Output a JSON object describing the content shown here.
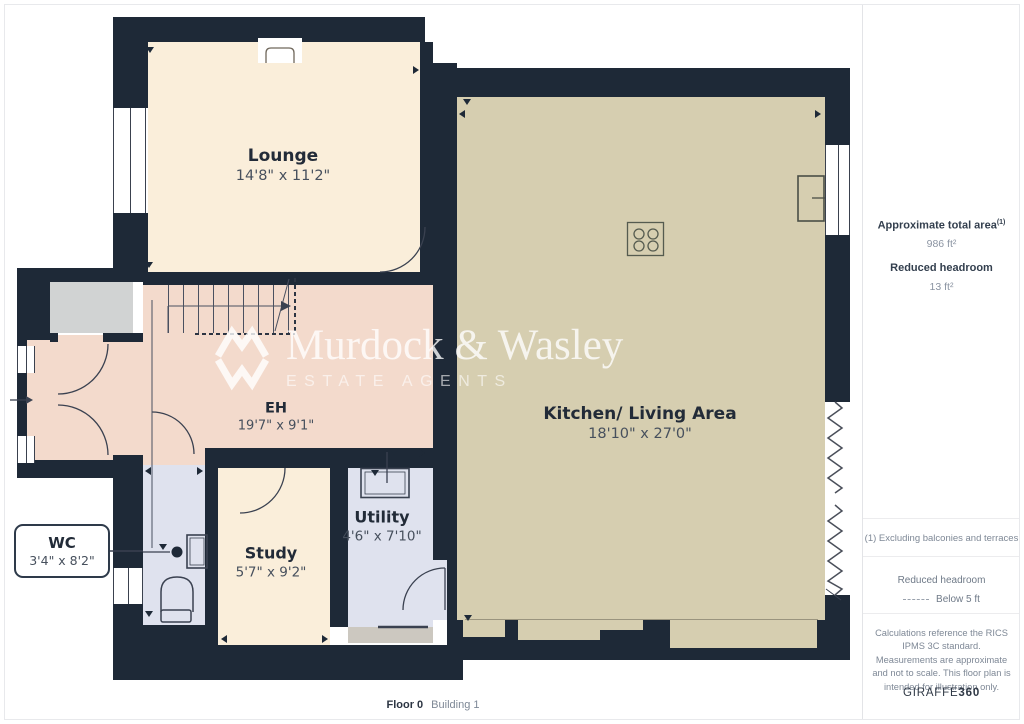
{
  "watermark": {
    "name": "Murdock & Wasley",
    "tagline": "ESTATE AGENTS",
    "logo": "mw-chevron-logo"
  },
  "rooms": [
    {
      "name": "Lounge",
      "dims": "14'8\" x 11'2\""
    },
    {
      "name": "Kitchen/ Living Area",
      "dims": "18'10\" x 27'0\""
    },
    {
      "name": "EH",
      "dims": "19'7\" x 9'1\""
    },
    {
      "name": "Study",
      "dims": "5'7\" x 9'2\""
    },
    {
      "name": "Utility",
      "dims": "4'6\" x 7'10\""
    },
    {
      "name": "WC",
      "dims": "3'4\" x 8'2\""
    }
  ],
  "footer": {
    "floor": "Floor 0",
    "building": "Building 1"
  },
  "sidebar": {
    "total_area_label": "Approximate total area",
    "total_area_sup": "(1)",
    "total_area_value": "986 ft²",
    "reduced_headroom_label": "Reduced headroom",
    "reduced_headroom_value": "13 ft²",
    "note1": "(1) Excluding balconies and terraces",
    "legend_title": "Reduced headroom",
    "legend_value": "Below 5 ft",
    "disclaimer": "Calculations reference the RICS IPMS 3C standard. Measurements are approximate and not to scale. This floor plan is intended for illustration only.",
    "brand": "GIRAFFE",
    "brand_bold": "360"
  },
  "colors": {
    "wall": "#1e2937",
    "lounge_floor": "#faeeda",
    "hall_floor": "#f3dacc",
    "kitchen_floor": "#d6ceb0",
    "wet_room_floor": "#dfe2ee",
    "porch_floor": "#d1d3d3",
    "vestibule_floor": "#ccc8c0"
  }
}
